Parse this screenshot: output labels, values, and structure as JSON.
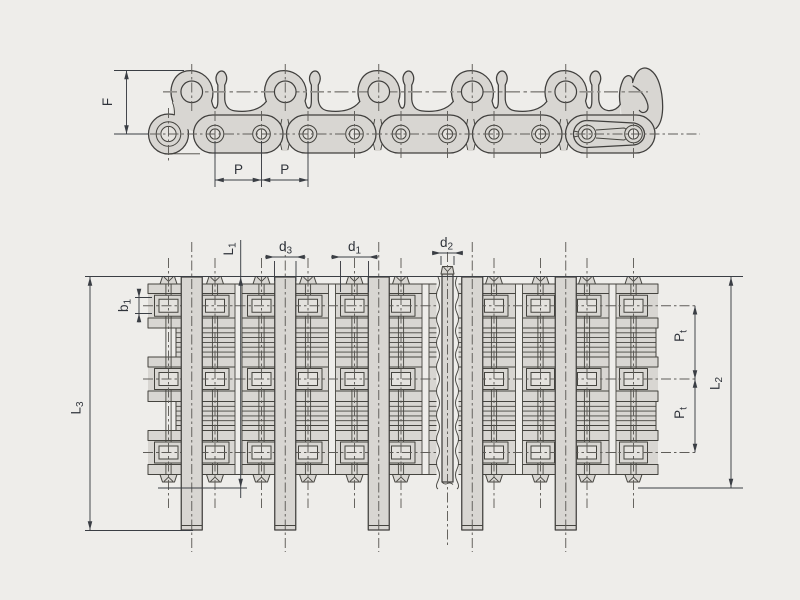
{
  "page": {
    "background": "#eeedea"
  },
  "drawing": {
    "title": "multi-strand-roller-chain-dimension-drawing",
    "side_view": {
      "dims": {
        "f": {
          "main": "F",
          "sub": ""
        },
        "p1": {
          "main": "P",
          "sub": ""
        },
        "p2": {
          "main": "P",
          "sub": ""
        }
      }
    },
    "plan_view": {
      "dims": {
        "l1": {
          "main": "L",
          "sub": "1"
        },
        "d3": {
          "main": "d",
          "sub": "3"
        },
        "d1": {
          "main": "d",
          "sub": "1"
        },
        "d2": {
          "main": "d",
          "sub": "2"
        },
        "b1": {
          "main": "b",
          "sub": "1"
        },
        "l3": {
          "main": "L",
          "sub": "3"
        },
        "l2": {
          "main": "L",
          "sub": "2"
        },
        "pt_upper": {
          "main": "P",
          "sub": "t"
        },
        "pt_lower": {
          "main": "P",
          "sub": "t"
        }
      }
    },
    "colors": {
      "background": "#eeedea",
      "part_fill": "#d8d6d2",
      "part_inner_fill": "#e4e2de",
      "outline": "#403f3d",
      "centerline": "#5f5d59",
      "dimension": "#3a3e44"
    }
  }
}
